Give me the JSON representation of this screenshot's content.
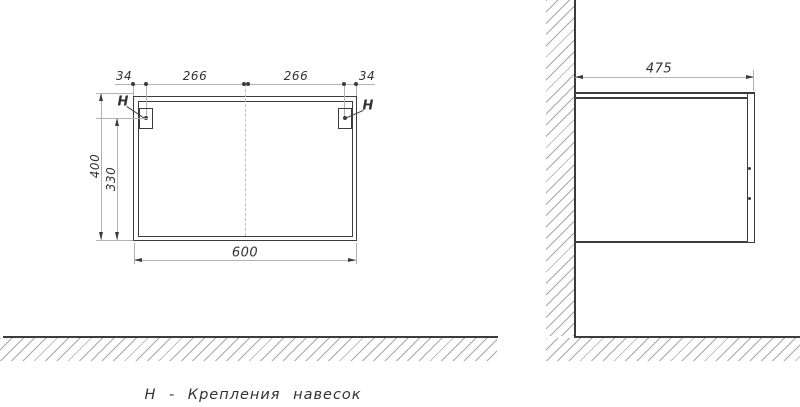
{
  "front_view": {
    "top_dims": [
      "34",
      "266",
      "266",
      "34"
    ],
    "height_dim": "400",
    "mount_height_dim": "330",
    "width_dim": "600",
    "hanger_note_left": "H",
    "hanger_note_right": "H"
  },
  "side_view": {
    "depth_dim": "475"
  },
  "caption": "Н - Крепления навесок",
  "colors": {
    "line": "#3c3c3c",
    "dim": "#b2b2b2",
    "hatch": "#a8a8a8",
    "text": "#333333"
  }
}
